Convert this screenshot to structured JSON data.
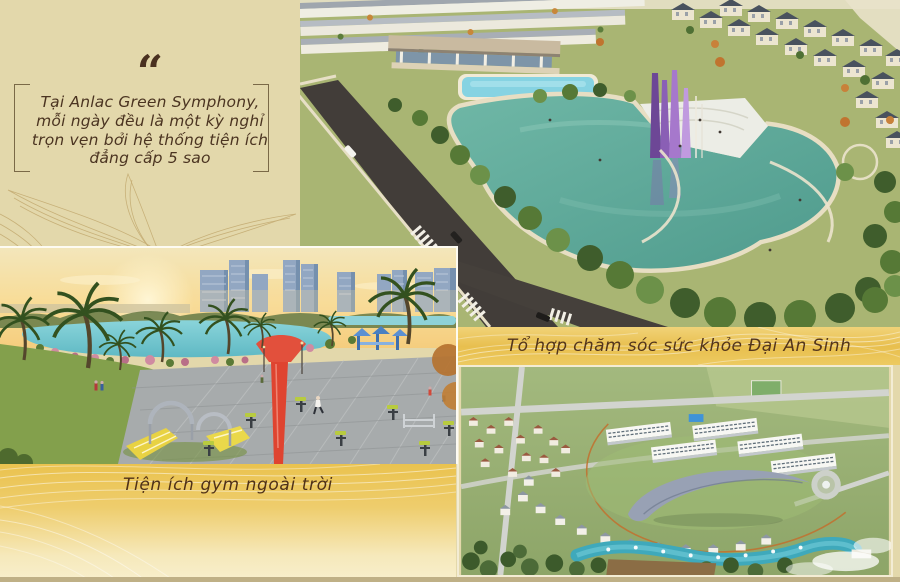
{
  "quote": {
    "mark": "“",
    "lines": [
      "Tại Anlac Green Symphony,",
      "mỗi ngày đều là một kỳ nghỉ",
      "trọn vẹn bởi hệ thống tiện ích",
      "đẳng cấp 5 sao"
    ]
  },
  "captions": {
    "health_complex": "Tổ hợp chăm sóc sức khỏe Đại An Sinh",
    "outdoor_gym": "Tiện ích gym ngoài trời"
  },
  "images": {
    "lake_park": {
      "description": "Aerial render of the central lake park with purple sail sculptures, clubhouse, pool, townhouses and villas"
    },
    "outdoor_gym": {
      "description": "Outdoor gym plaza at sunset with yellow playground slides, red sculpture, palm trees, lake and high-rise skyline"
    },
    "health_complex": {
      "description": "Aerial render of the Dai An Sinh healthcare complex with curved canopy roof, white blocks, villas and winding blue lake"
    }
  },
  "colors": {
    "background": "#e3d8ab",
    "gold": "#e8bf4e",
    "gold_pale": "#f8efcd",
    "text_brown": "#4b3421",
    "bottom_strip": "#bfb086"
  }
}
